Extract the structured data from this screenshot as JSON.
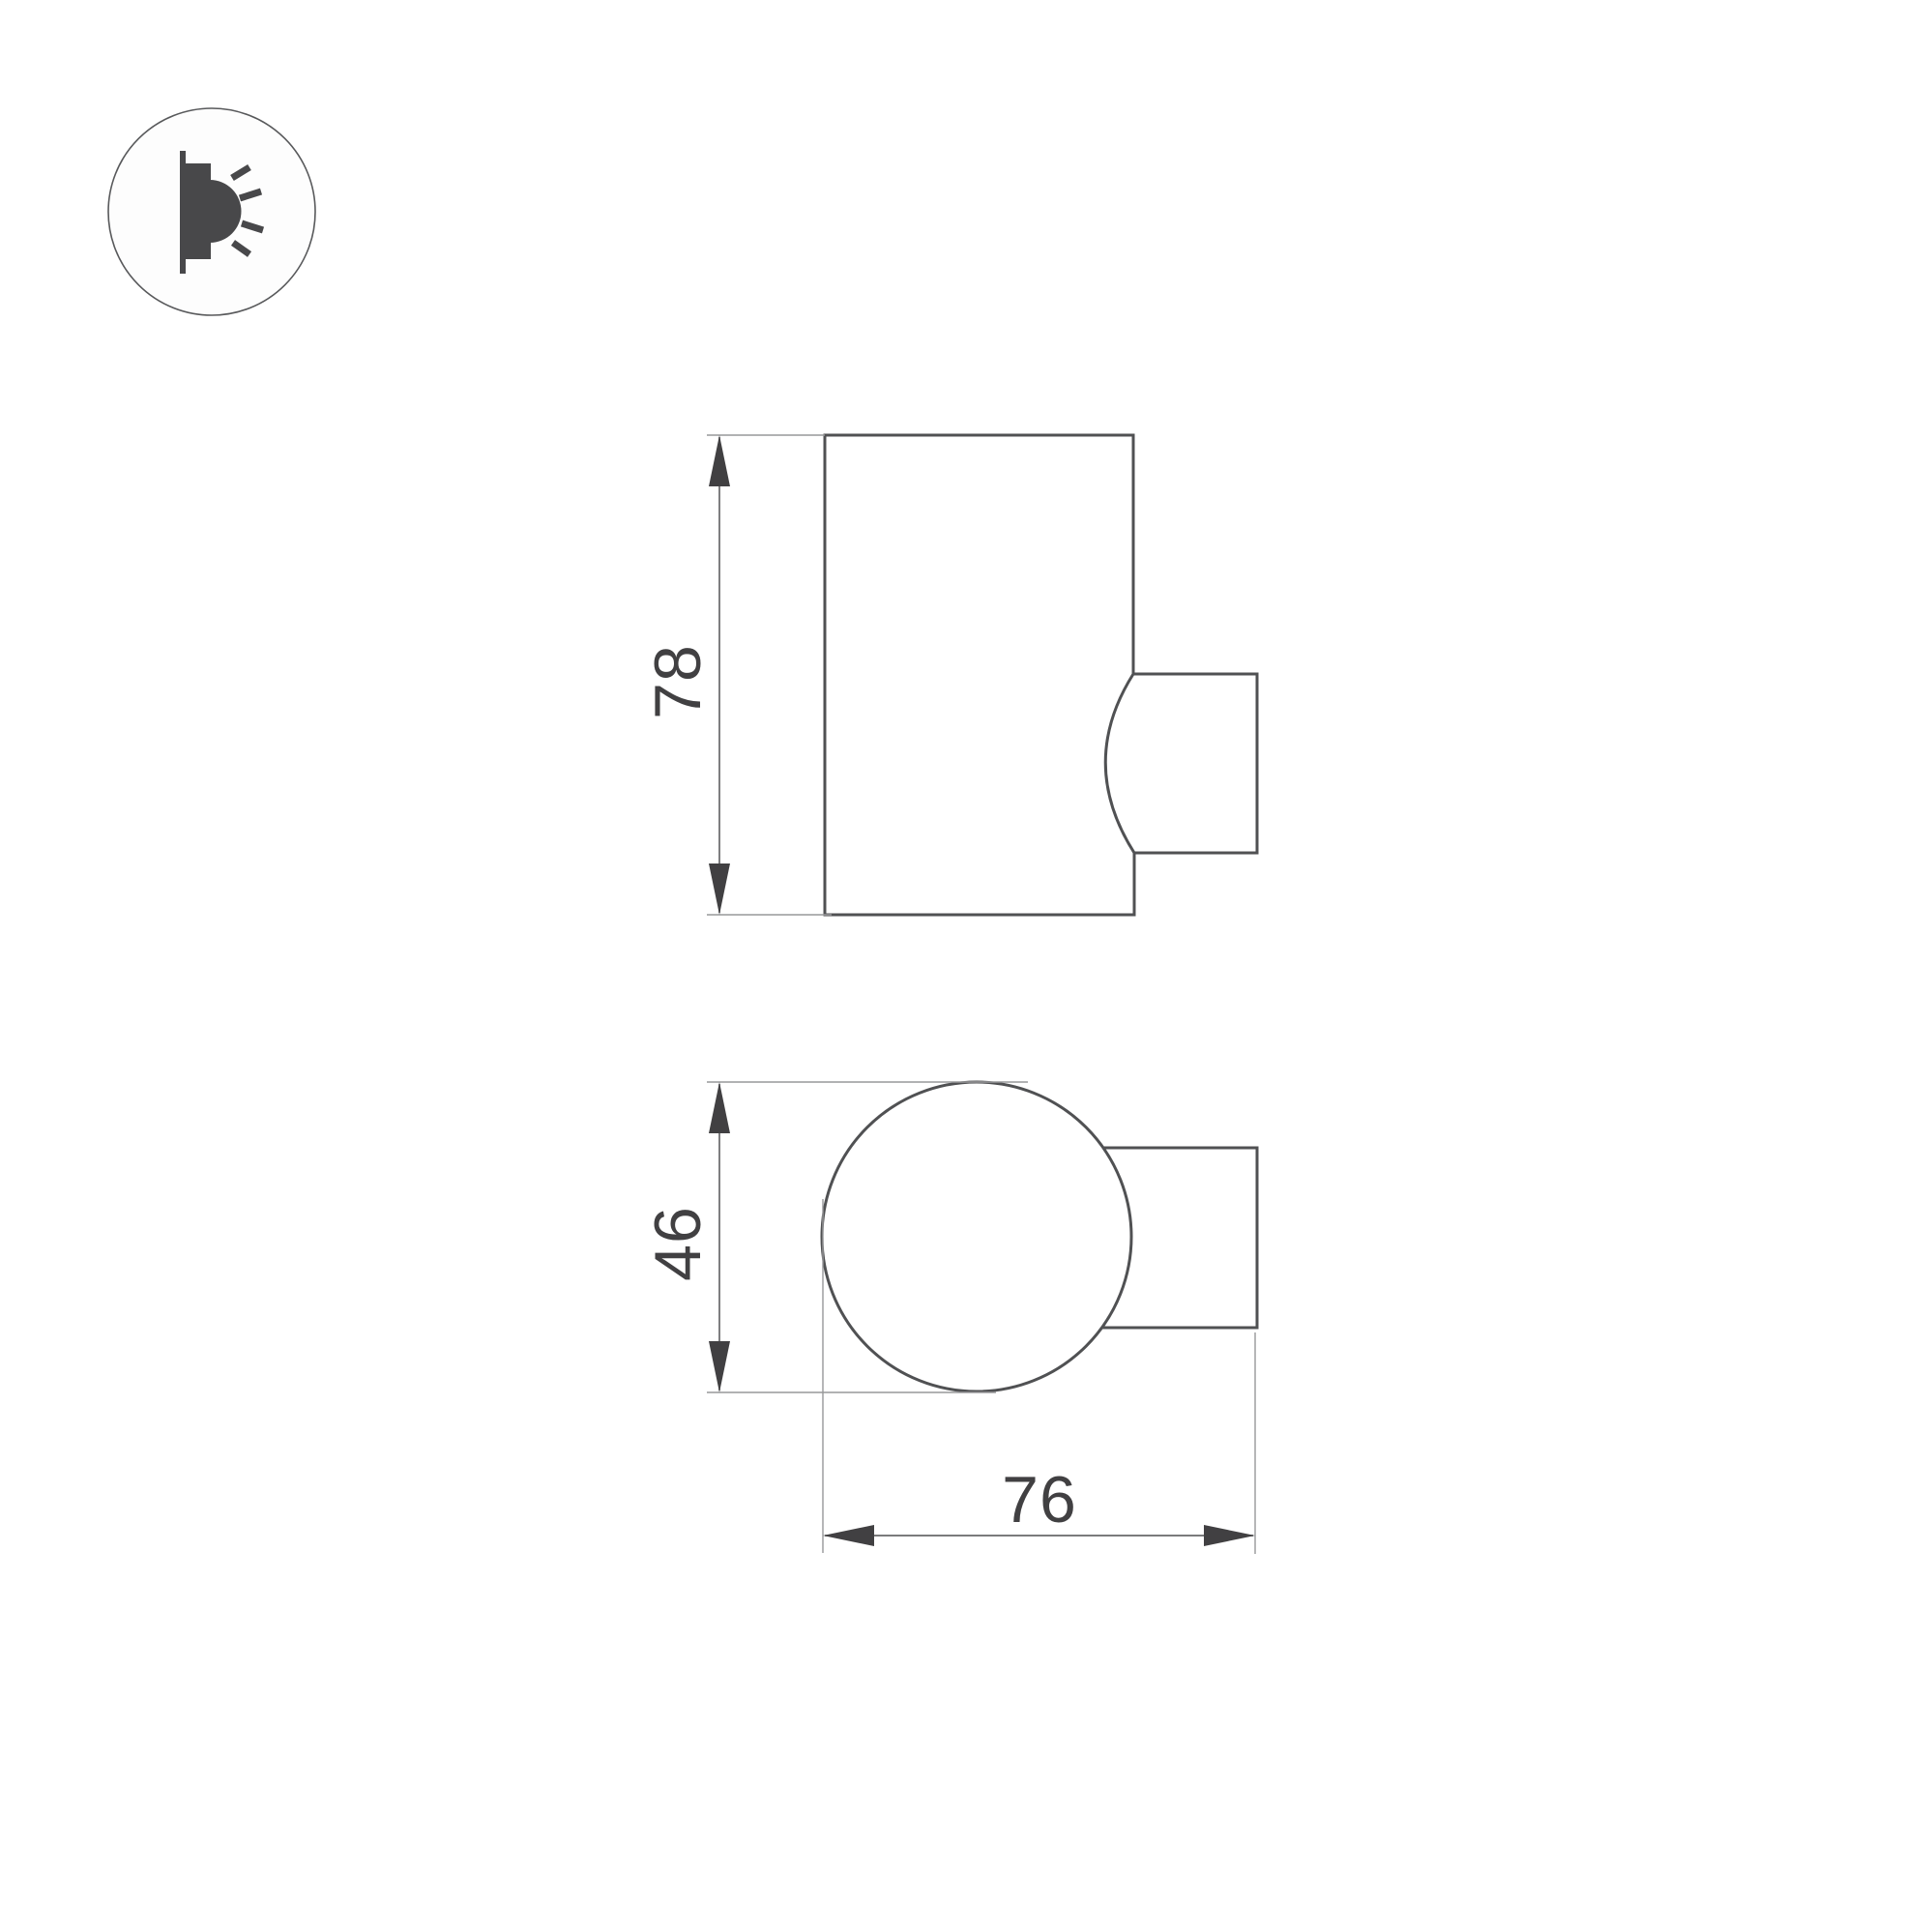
{
  "labels": {
    "side_height": "78",
    "top_diameter": "46",
    "top_width": "76"
  },
  "icons": {
    "badge": "wall-light-icon"
  },
  "colors": {
    "outline": "#505153",
    "dimension_line": "#67686a",
    "extension_line": "#97989a",
    "label_text": "#414042",
    "icon_fill": "#48484a",
    "background": "#ffffff"
  }
}
